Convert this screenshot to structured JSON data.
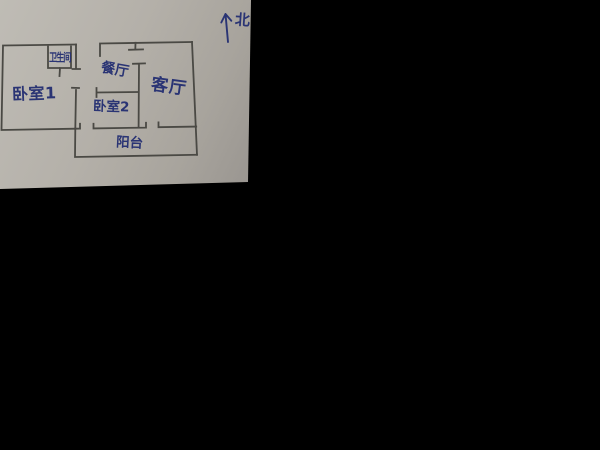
{
  "scene": {
    "description": "Photo of a hand-drawn apartment floor plan sketch on gray paper over a black background",
    "background_color": "#000000",
    "paper_color": "#b3afa8",
    "ink_wall_color": "#4a4944",
    "ink_text_color": "#2a3474"
  },
  "compass": {
    "symbol": "up-arrow",
    "label": "北"
  },
  "rooms": {
    "bedroom1": {
      "label": "卧室1"
    },
    "bathroom": {
      "label": "卫生间"
    },
    "dining": {
      "label": "餐厅"
    },
    "living": {
      "label": "客厅"
    },
    "bedroom2": {
      "label": "卧室2"
    },
    "balcony": {
      "label": "阳台"
    }
  }
}
